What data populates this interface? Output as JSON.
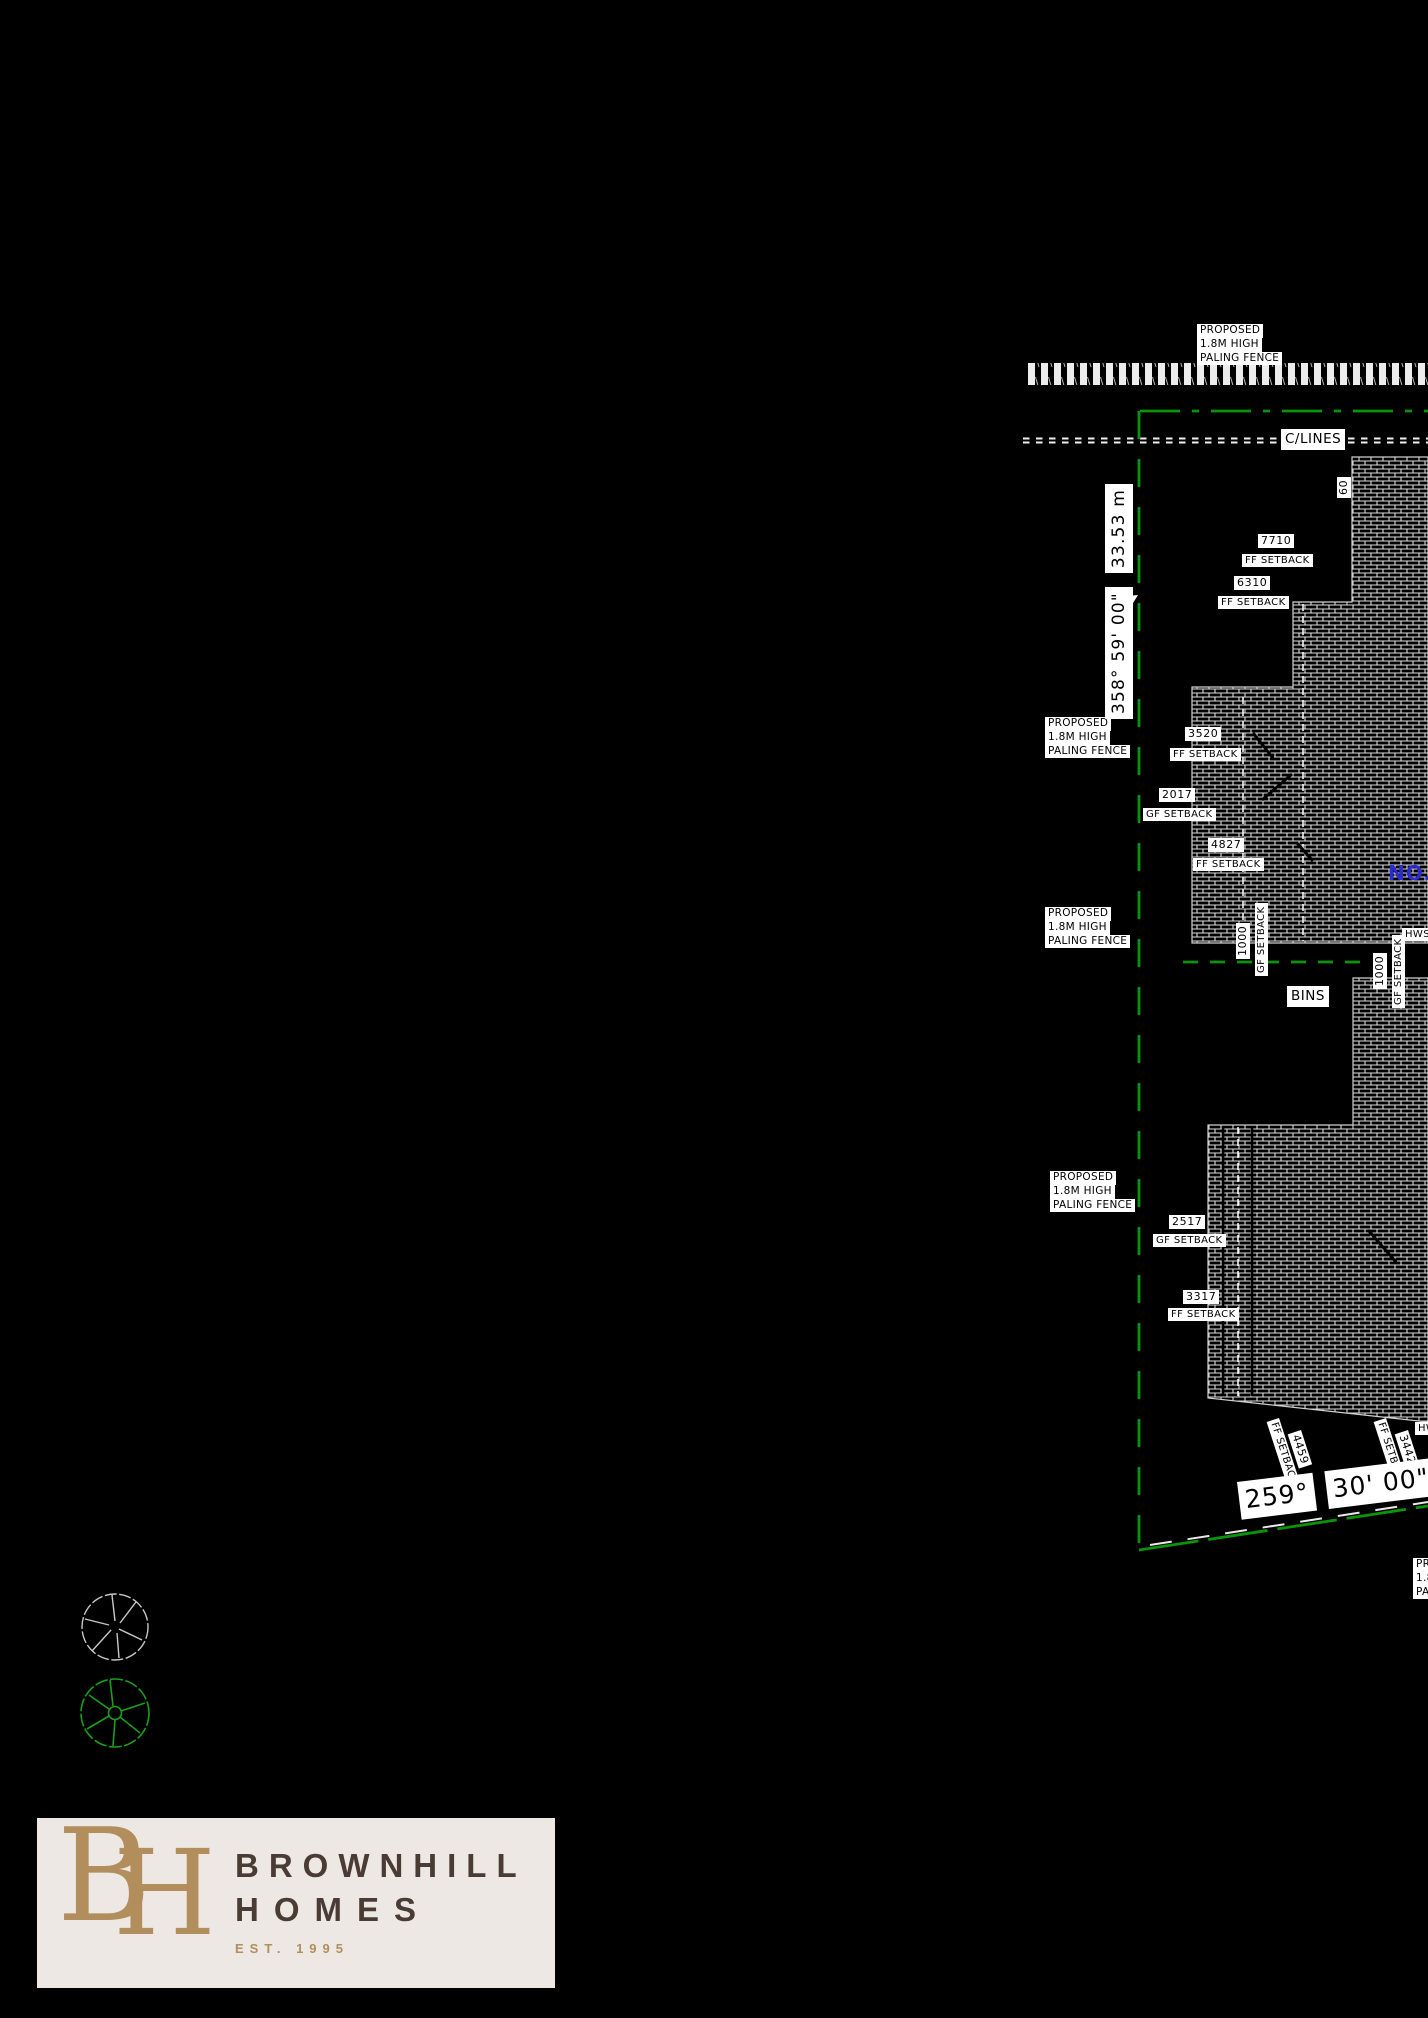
{
  "labels": {
    "fence": [
      "PROPOSED",
      "1.8M HIGH",
      "PALING FENCE"
    ],
    "clines": "C/LINES",
    "north": {
      "bearing": "358° 59' 00\"",
      "distance": "33.53 m"
    },
    "sixty": "60",
    "s7710": {
      "v": "7710",
      "t": "FF SETBACK"
    },
    "s6310": {
      "v": "6310",
      "t": "FF SETBACK"
    },
    "s3520": {
      "v": "3520",
      "t": "FF SETBACK"
    },
    "s2017": {
      "v": "2017",
      "t": "GF SETBACK"
    },
    "s4827": {
      "v": "4827",
      "t": "FF SETBACK"
    },
    "s1000a": {
      "v": "1000",
      "t": "GF SETBACK"
    },
    "s1000b": {
      "v": "1000",
      "t": "GF SETBACK"
    },
    "s2517": {
      "v": "2517",
      "t": "GF SETBACK"
    },
    "s3317": {
      "v": "3317",
      "t": "FF SETBACK"
    },
    "s4459": {
      "v": "4459",
      "t": "FF SETBACK"
    },
    "s3442": {
      "v": "3442",
      "t": "FF SETBACK"
    },
    "bins": "BINS",
    "hws": "HWS",
    "hw_partial": "HWS",
    "blue_note": "NO.",
    "south": {
      "deg": "259°",
      "min": "30' 00\"",
      "dist": "18"
    }
  },
  "logo": {
    "mono_b": "B",
    "mono_h": "H",
    "name1": "BROWNHILL",
    "name2": "HOMES",
    "est": "EST. 1995"
  },
  "colors": {
    "boundary_green": "#0a9408",
    "note_blue": "#2b2bd0",
    "logo_gold": "#B28E5C",
    "logo_brown": "#4A3C35",
    "logo_background": "#EDE8E3",
    "linework_white": "#e3e3e3"
  }
}
